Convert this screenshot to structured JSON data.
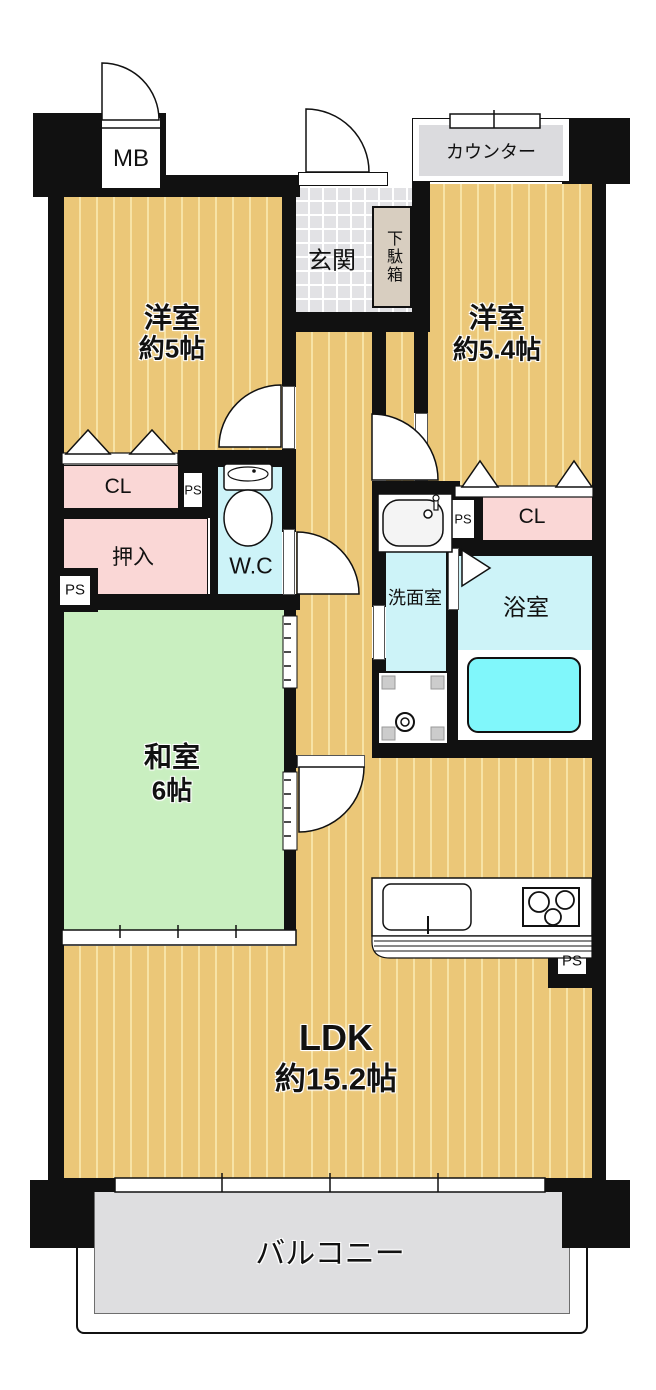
{
  "plan": {
    "meter_box_label": "MB",
    "counter_label": "カウンター",
    "entrance_label": "玄関",
    "shoe_box_label": "下駄箱",
    "western_room_1": {
      "name": "洋室",
      "size": "約5帖"
    },
    "western_room_2": {
      "name": "洋室",
      "size": "約5.4帖"
    },
    "closet_left_label": "CL",
    "closet_right_label": "CL",
    "oshiire_label": "押入",
    "toilet_label": "W.C",
    "washroom_label": "洗面室",
    "bathroom_label": "浴室",
    "japanese_room": {
      "name": "和室",
      "size": "6帖"
    },
    "ldk": {
      "name": "LDK",
      "size": "約15.2帖"
    },
    "balcony_label": "バルコニー",
    "pipe_space_label": "PS"
  },
  "colors": {
    "wall": "#111111",
    "wood_floor": "#ebc778",
    "wood_floor_stripe": "#f7e3a6",
    "tatami_green": "#c9efc0",
    "closet_pink": "#fad7d6",
    "water_cyan": "#cdf3f8",
    "bathtub_cyan": "#80f7fb",
    "entrance_tile_gray": "#e2e2e5",
    "balcony_gray": "#dedee0",
    "shoe_box_beige": "#d8cec0"
  }
}
